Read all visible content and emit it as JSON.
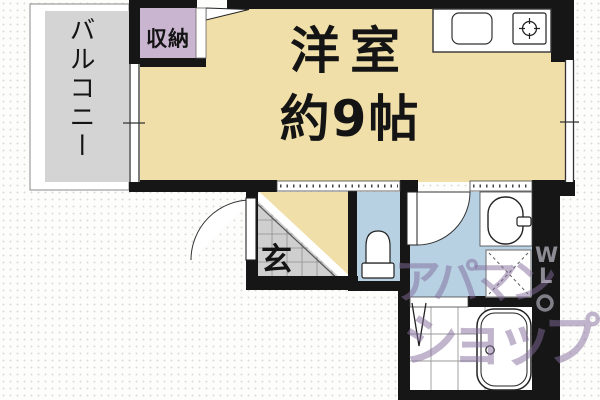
{
  "rooms": {
    "main": {
      "name": "洋室",
      "size": "約9帖"
    },
    "balcony": {
      "label": "バルコニー"
    },
    "storage": {
      "label": "収納"
    },
    "entrance": {
      "label": "玄"
    }
  },
  "watermark": {
    "line1": "アパマン",
    "line2": "ショップ",
    "side_letters": [
      "W",
      "L"
    ]
  },
  "colors": {
    "wall": "#161616",
    "room_fill": "#f0dfa8",
    "storage_fill": "#c9b5cf",
    "balcony_fill": "#d4d4d4",
    "wet_area_fill": "#b7d0e2",
    "entrance_tile_fill": "#cfcfcf",
    "fixture_fill": "#ffffff",
    "watermark_purple": "#826c9c"
  }
}
